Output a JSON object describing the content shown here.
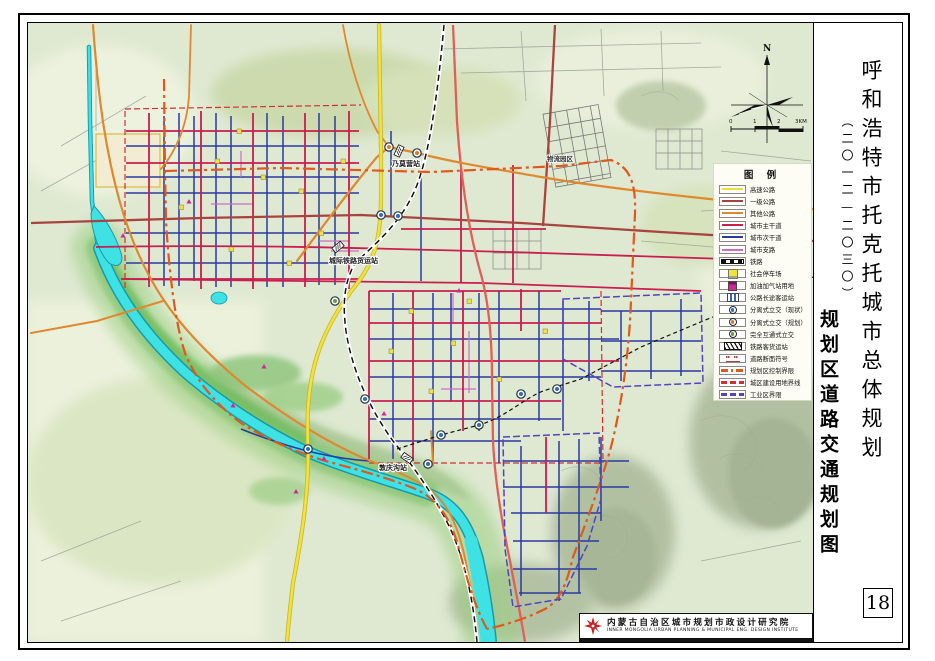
{
  "title_panel": {
    "main_title": "呼和浩特市托克托城市总体规划",
    "period": "（二〇一二—二〇三〇）",
    "map_name": "规划区道路交通规划图",
    "page_number": "18"
  },
  "compass": {
    "north_label": "N"
  },
  "scale_bar": {
    "ticks": [
      "0",
      "1",
      "2",
      "3KM"
    ]
  },
  "legend": {
    "title": "图  例",
    "items": [
      {
        "label": "高速公路",
        "color": "#f0df38"
      },
      {
        "label": "一级公路",
        "color": "#a84440"
      },
      {
        "label": "其他公路",
        "color": "#e0882e"
      },
      {
        "label": "城市主干道",
        "color": "#c81e50"
      },
      {
        "label": "城市次干道",
        "color": "#2a3aa0"
      },
      {
        "label": "城市支路",
        "color": "#d06cc4"
      },
      {
        "label": "铁路",
        "color": "#111111"
      },
      {
        "label": "社会停车场",
        "color": "#f2e23c"
      },
      {
        "label": "加油加气站用地",
        "color": "#d0289c"
      },
      {
        "label": "公路长途客运站",
        "color": "#3a62b4"
      },
      {
        "label": "分离式立交（现状）",
        "color": "#2a6ac8"
      },
      {
        "label": "分离式立交（规划）",
        "color": "#e07820"
      },
      {
        "label": "完全互通式立交",
        "color": "#58a234"
      },
      {
        "label": "铁路客货运站",
        "color": "#111111"
      },
      {
        "label": "道路断面符号",
        "color": "#b04040"
      },
      {
        "label": "规划区控制界限",
        "color": "#e0581a"
      },
      {
        "label": "城区建设用地界线",
        "color": "#d03030"
      },
      {
        "label": "工业区界限",
        "color": "#5244c0"
      }
    ]
  },
  "map_labels": [
    {
      "text": "乃莫营站"
    },
    {
      "text": "城际铁路货运站"
    },
    {
      "text": "敦庆沟站"
    },
    {
      "text": "物流园区"
    }
  ],
  "footer": {
    "institute_cn": "内蒙古自治区城市规划市政设计研究院",
    "institute_en": "INNER MONGOLIA URBAN PLANNING & MUNICIPAL ENG. DESIGN INSTITUTE"
  }
}
